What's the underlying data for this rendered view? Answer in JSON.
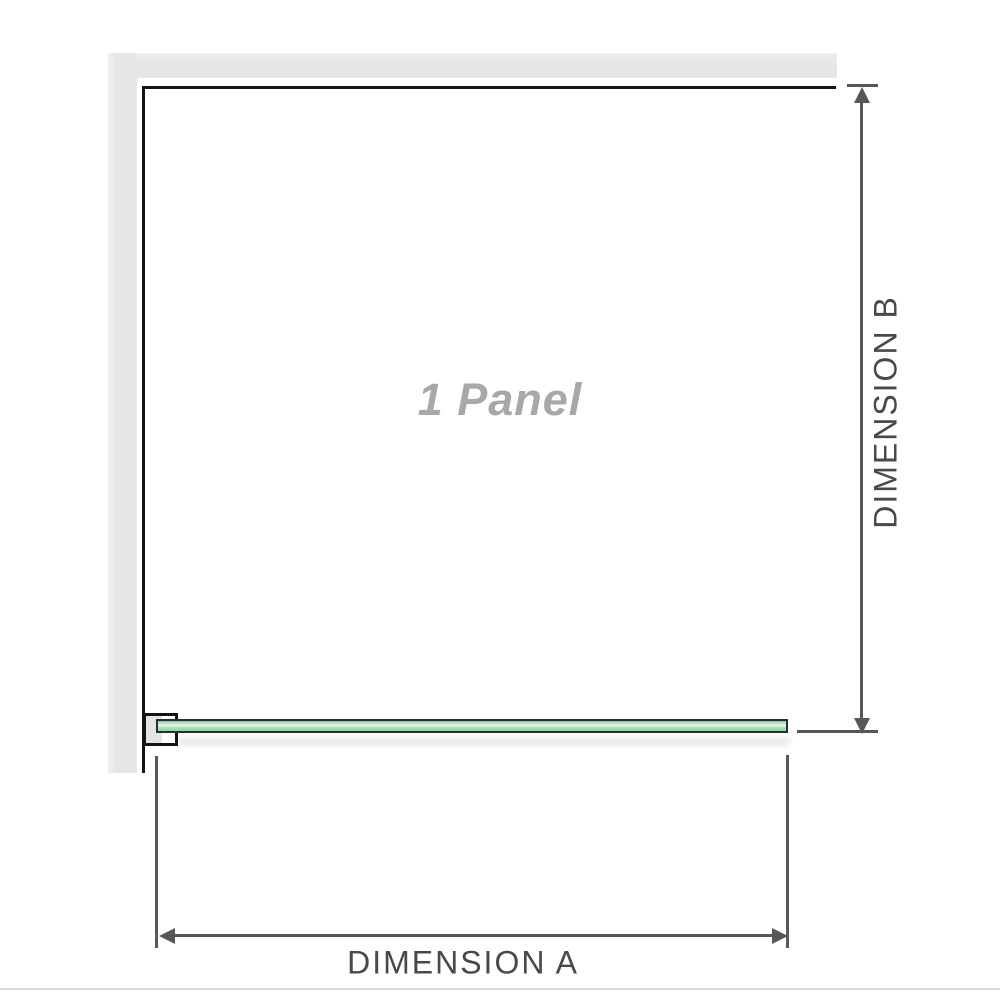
{
  "diagram": {
    "title": "1 Panel",
    "dimension_a": {
      "label": "DIMENSION A"
    },
    "dimension_b": {
      "label": "DIMENSION B"
    }
  },
  "icons": {
    "arrow_up": "triangle-up",
    "arrow_down": "triangle-down",
    "arrow_left": "triangle-left",
    "arrow_right": "triangle-right"
  },
  "colors": {
    "background": "#ffffff",
    "wall_fill": "#e7e7e8",
    "enclosure_outline": "#141414",
    "dimension_line": "#55585b",
    "dimension_text": "#47494c",
    "panel_title_text": "#a8a8a8",
    "glass_outline": "#27302a",
    "glass_fill_light": "#e9f7ef",
    "glass_fill_mid": "#9cd8ae",
    "bracket_inset_fill": "#e4e4e4",
    "footer_divider": "#dadada"
  }
}
